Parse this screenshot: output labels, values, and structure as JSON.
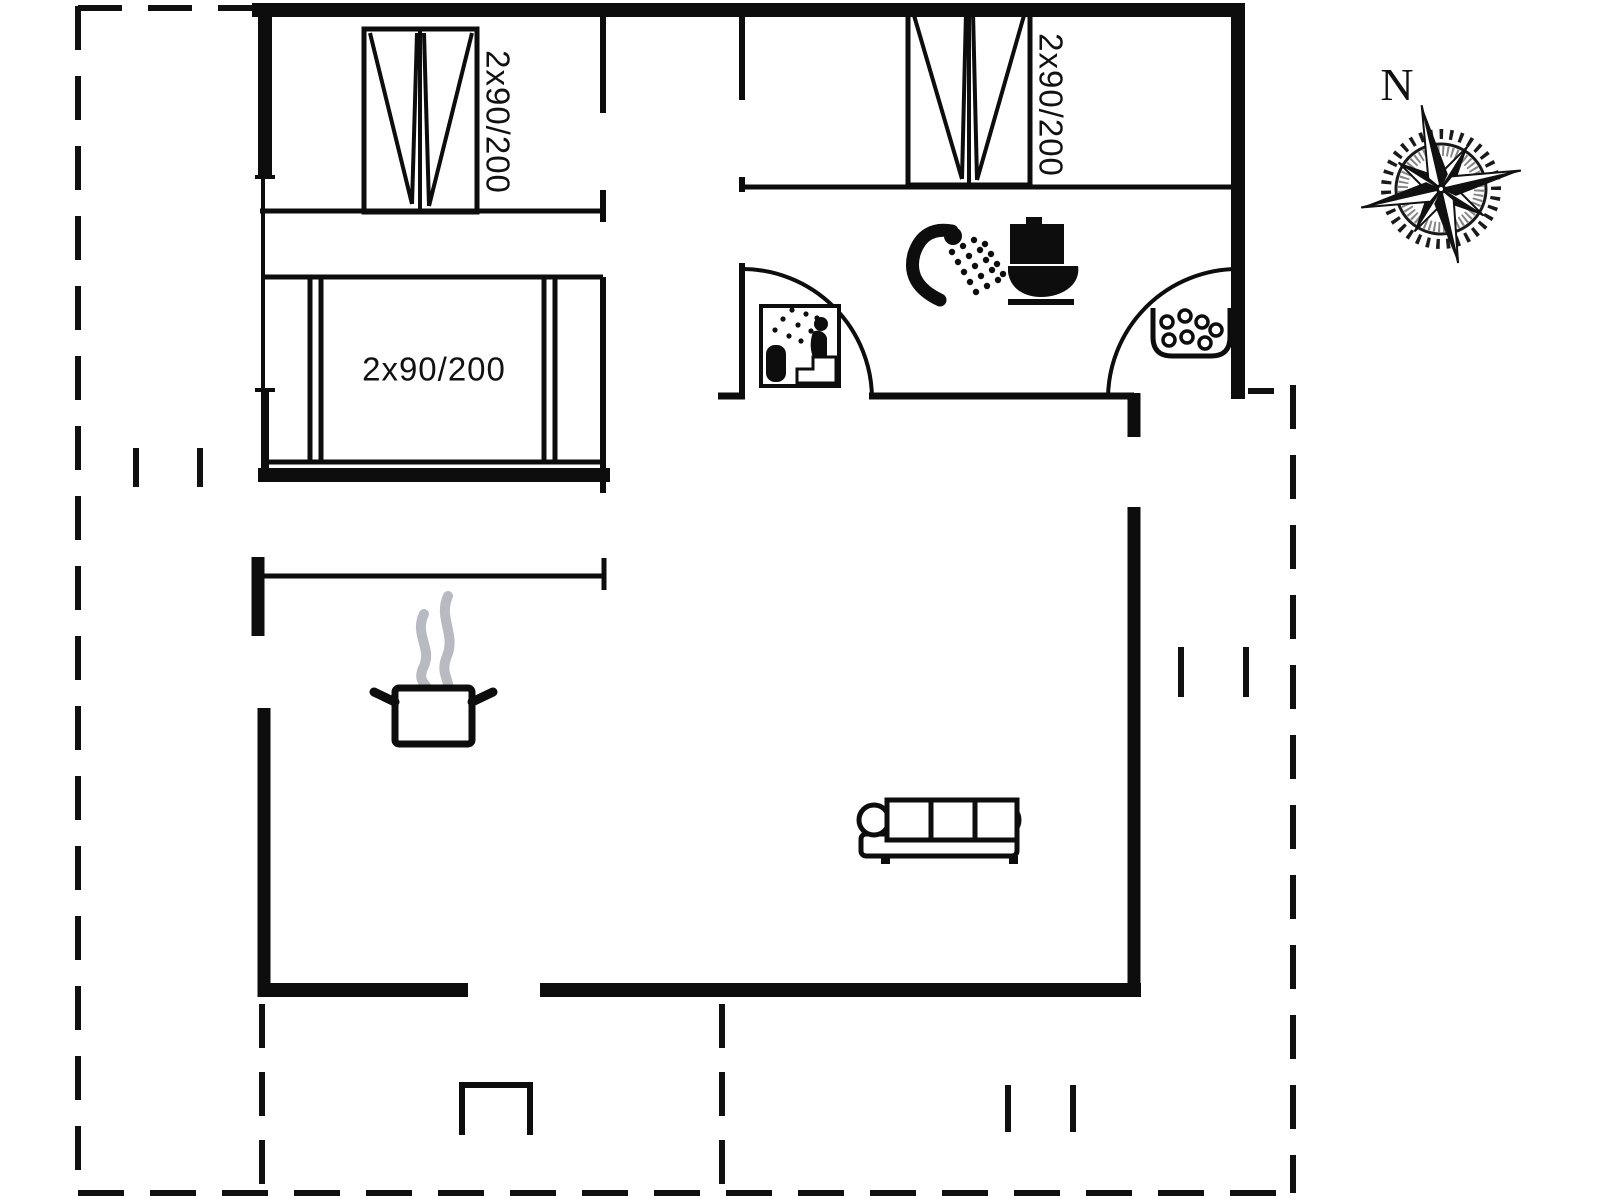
{
  "title": "Holiday house floor plan",
  "colors": {
    "background": "#ffffff",
    "wall": "#0d0d0d",
    "steam_gray": "#b7bac1"
  },
  "compass": {
    "label": "N"
  },
  "rooms": {
    "bedroom_top_left": {
      "bed_label": "2x90/200"
    },
    "bedroom_top_right": {
      "bed_label": "2x90/200"
    },
    "bedroom_mid_left": {
      "bed_label": "2x90/200"
    }
  },
  "icons": [
    "double-bed-icon",
    "double-bed-icon",
    "double-bed-icon",
    "shower-icon",
    "toilet-icon",
    "sauna-icon",
    "whirlpool-icon",
    "cooking-pot-icon",
    "sofa-icon",
    "door-swing-arc",
    "compass-rose-icon"
  ]
}
